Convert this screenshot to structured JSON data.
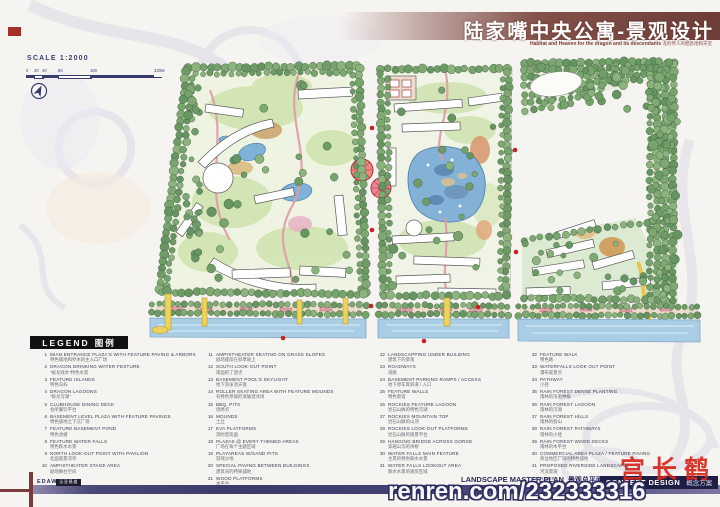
{
  "title": {
    "main": "陆家嘴中央公寓-景观设计",
    "subtitle_en": "Habitat and Heaven for the dragon and its descendants",
    "subtitle_cn": "龙的传人的栖息地和天堂"
  },
  "scale": {
    "label": "SCALE 1:2000",
    "ticks": [
      "0",
      "20",
      "40",
      "80",
      "160",
      "320M"
    ]
  },
  "legend": {
    "title_en": "LEGEND",
    "title_cn": "图例",
    "columns": [
      [
        {
          "n": "1",
          "en": "MIAN ENTRANCE PLAZA'S WITH FEATURE PAVING & ARBORS",
          "cn": "特色铺地和乔木的主入口广场"
        },
        {
          "n": "2",
          "en": "DRAGON DRINKING WATER FESTURE",
          "cn": "\"蛟龙戏水\"特色水景"
        },
        {
          "n": "3",
          "en": "FEATURE ISLANDS",
          "cn": "特色岛屿"
        },
        {
          "n": "4",
          "en": "DRAGON LAGOONS",
          "cn": "\"蛟龙泻湖\""
        },
        {
          "n": "5",
          "en": "CLUBHOUSE DINING DECK",
          "cn": "会所餐饮平台"
        },
        {
          "n": "6",
          "en": "BASEMENT LEVEL PLAZA WITH FEATURE PAVINGS",
          "cn": "特色铺地之下沉广场"
        },
        {
          "n": "7",
          "en": "FEATURE BASEMENT POND",
          "cn": "特色池塘"
        },
        {
          "n": "8",
          "en": "FEATURE WATER FALLS",
          "cn": "特色跌水水景"
        },
        {
          "n": "9",
          "en": "NORTH LOOK-OUT POINT WITH PAVILION",
          "cn": "北面观景凉亭"
        },
        {
          "n": "10",
          "en": "AMPHITHEATER STAGE AREA",
          "cn": "剧场舞台空间"
        }
      ],
      [
        {
          "n": "11",
          "en": "AMPHITHEATER SEATING ON GRASS SLOPES",
          "cn": "剧场座席在斜草坡上"
        },
        {
          "n": "12",
          "en": "SOUTH LOOK-OUT POINT",
          "cn": "南面的了望点"
        },
        {
          "n": "13",
          "en": "BASEMENT POOL'S SKYLIGHT",
          "cn": "地下游泳池天窗"
        },
        {
          "n": "14",
          "en": "ROLLER SKATING AREA WITH FEATURE MOUNDS",
          "cn": "有特色草坡的滚轴溜冰场"
        },
        {
          "n": "15",
          "en": "BBQ. PITS",
          "cn": "烧烤点"
        },
        {
          "n": "16",
          "en": "MOUNDS",
          "cn": "土丘"
        },
        {
          "n": "17",
          "en": "EVA PLATFORMS",
          "cn": "消防登高面"
        },
        {
          "n": "18",
          "en": "PLAZAS @ EVERY THEMED AREAS",
          "cn": "广场在每个主题区域"
        },
        {
          "n": "19",
          "en": "PLAYAREAS W/SAND PITS",
          "cn": "游戏沙地"
        },
        {
          "n": "20",
          "en": "SPECIAL PAVING BETWEEN BUILDINGS",
          "cn": "建筑间的特殊铺地"
        },
        {
          "n": "21",
          "en": "WOOD PLATFORMS",
          "cn": "木平台"
        }
      ],
      [
        {
          "n": "22",
          "en": "LANDSCAPPING UNDER BUILDING",
          "cn": "建筑下的景观"
        },
        {
          "n": "23",
          "en": "ROADWAYS",
          "cn": "道路"
        },
        {
          "n": "24",
          "en": "BASEMENT PARKING RAMPS / ACCESS",
          "cn": "地下停车库斜道 / 入口"
        },
        {
          "n": "25",
          "en": "FEATURE WALLS",
          "cn": "特色景墙"
        },
        {
          "n": "26",
          "en": "ROCKIES FEATURE LAGOON",
          "cn": "岩石山脉的特色泻湖"
        },
        {
          "n": "27",
          "en": "ROCKIES MOUNTAIN TOP",
          "cn": "岩石山脉的山顶"
        },
        {
          "n": "28",
          "en": "ROCKIES LOOK-OUT PLATFORMS",
          "cn": "岩石山脉的观景平台"
        },
        {
          "n": "29",
          "en": "HANGING BRIDGE ACROSS GORGE",
          "cn": "穿越山沟的吊桥"
        },
        {
          "n": "30",
          "en": "WATER FALLS MAIN FEATURE",
          "cn": "主景的特色跌水水景"
        },
        {
          "n": "31",
          "en": "WATER FALLS LOOKOUT AREA",
          "cn": "跌水水景的观赏区域"
        }
      ],
      [
        {
          "n": "32",
          "en": "FEATURE WALK",
          "cn": "特色路"
        },
        {
          "n": "33",
          "en": "WATERFALLS LOOK OUT POINT",
          "cn": "瀑布观景点"
        },
        {
          "n": "34",
          "en": "PATHWAY",
          "cn": "小径"
        },
        {
          "n": "35",
          "en": "RAIN FOREST DENSE PLANTING",
          "cn": "雨林的浓密种植"
        },
        {
          "n": "36",
          "en": "RAIN FOREST LAGOON",
          "cn": "雨林的泻湖"
        },
        {
          "n": "37",
          "en": "RAIN FOREST HILLS",
          "cn": "雨林的假山"
        },
        {
          "n": "38",
          "en": "RAIN FOREST PATHWAYS",
          "cn": "雨林的小径"
        },
        {
          "n": "39",
          "en": "RAIN FOREST WOOD DECKS",
          "cn": "雨林的木平台"
        },
        {
          "n": "40",
          "en": "COMMERCIAL AREA PLAZA / FEATURE PAVING",
          "cn": "商业地区广场的特色铺地"
        },
        {
          "n": "41",
          "en": "PROPOSED RIVERSIDE LANDSCAPE",
          "cn": "河滨景观"
        },
        {
          "n": "42",
          "en": "RIVER",
          "cn": "河"
        }
      ]
    ]
  },
  "footer": {
    "firm": "EDAW",
    "firm_cn": "泛亚易道",
    "plan_label_en": "LANDSCAPE MASTER PLAN",
    "plan_label_cn": "景观总平面",
    "concept_en": "CONCEPT DESIGN",
    "concept_cn": "概念方案"
  },
  "seal_text": "宫长鹤",
  "watermark": "renren.com/232333316",
  "colors": {
    "banner_maroon": "#6e3d38",
    "tree_green": "#7fa873",
    "water_blue": "#a9cde5",
    "navy_bar": "#3c3a6a",
    "seal_red": "#d6281c"
  }
}
